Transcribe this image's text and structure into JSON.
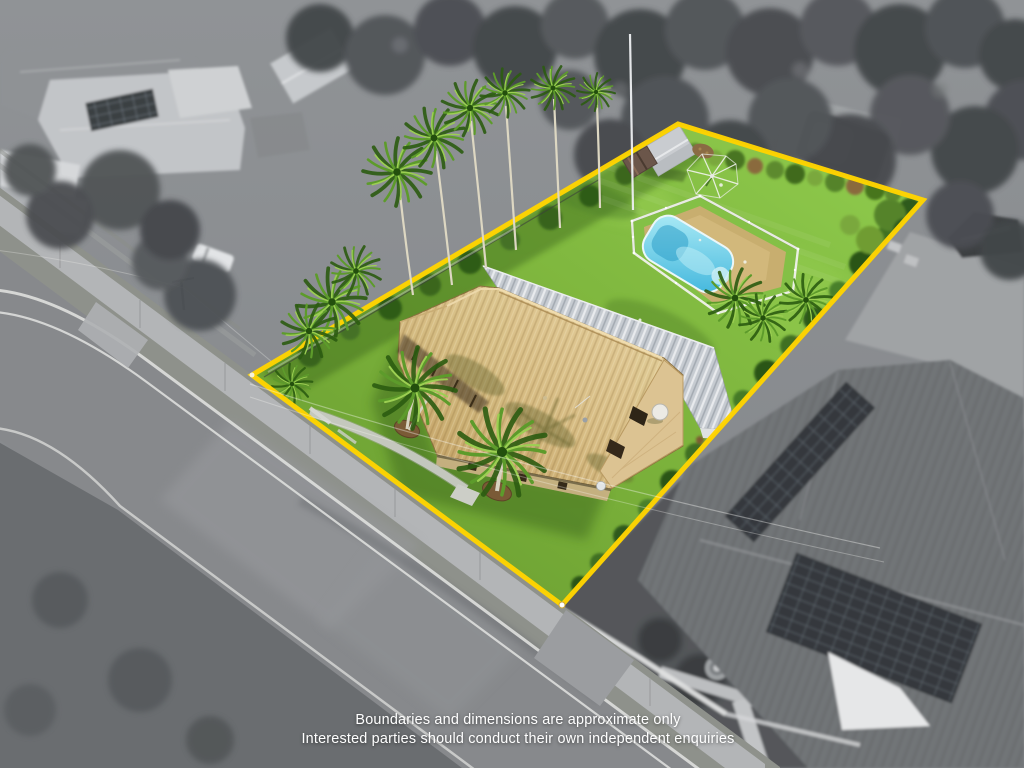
{
  "meta": {
    "image_kind": "aerial-drone-real-estate-photo",
    "effect": "subject property in colour, surroundings desaturated, yellow boundary overlay"
  },
  "disclaimer": {
    "line1": "Boundaries and dimensions are approximate only",
    "line2": "Interested parties should conduct their own independent enquiries"
  },
  "colors": {
    "boundary": "#FFD400",
    "lawn": "#7DB43C",
    "lawn_bright": "#90CC4E",
    "pool": "#3FB5DC",
    "pool_light": "#AEECF6",
    "roof_tan": "#D8BC84",
    "roof_gray": "#C6CBD1",
    "stone": "#DCC392",
    "asphalt": "#87898C",
    "concrete": "#B5B7B9",
    "white_line": "#DCDDDB",
    "tree_gray": "#4B4E51",
    "panel_dark": "#3A3F43",
    "text": "#FFFFFF"
  }
}
